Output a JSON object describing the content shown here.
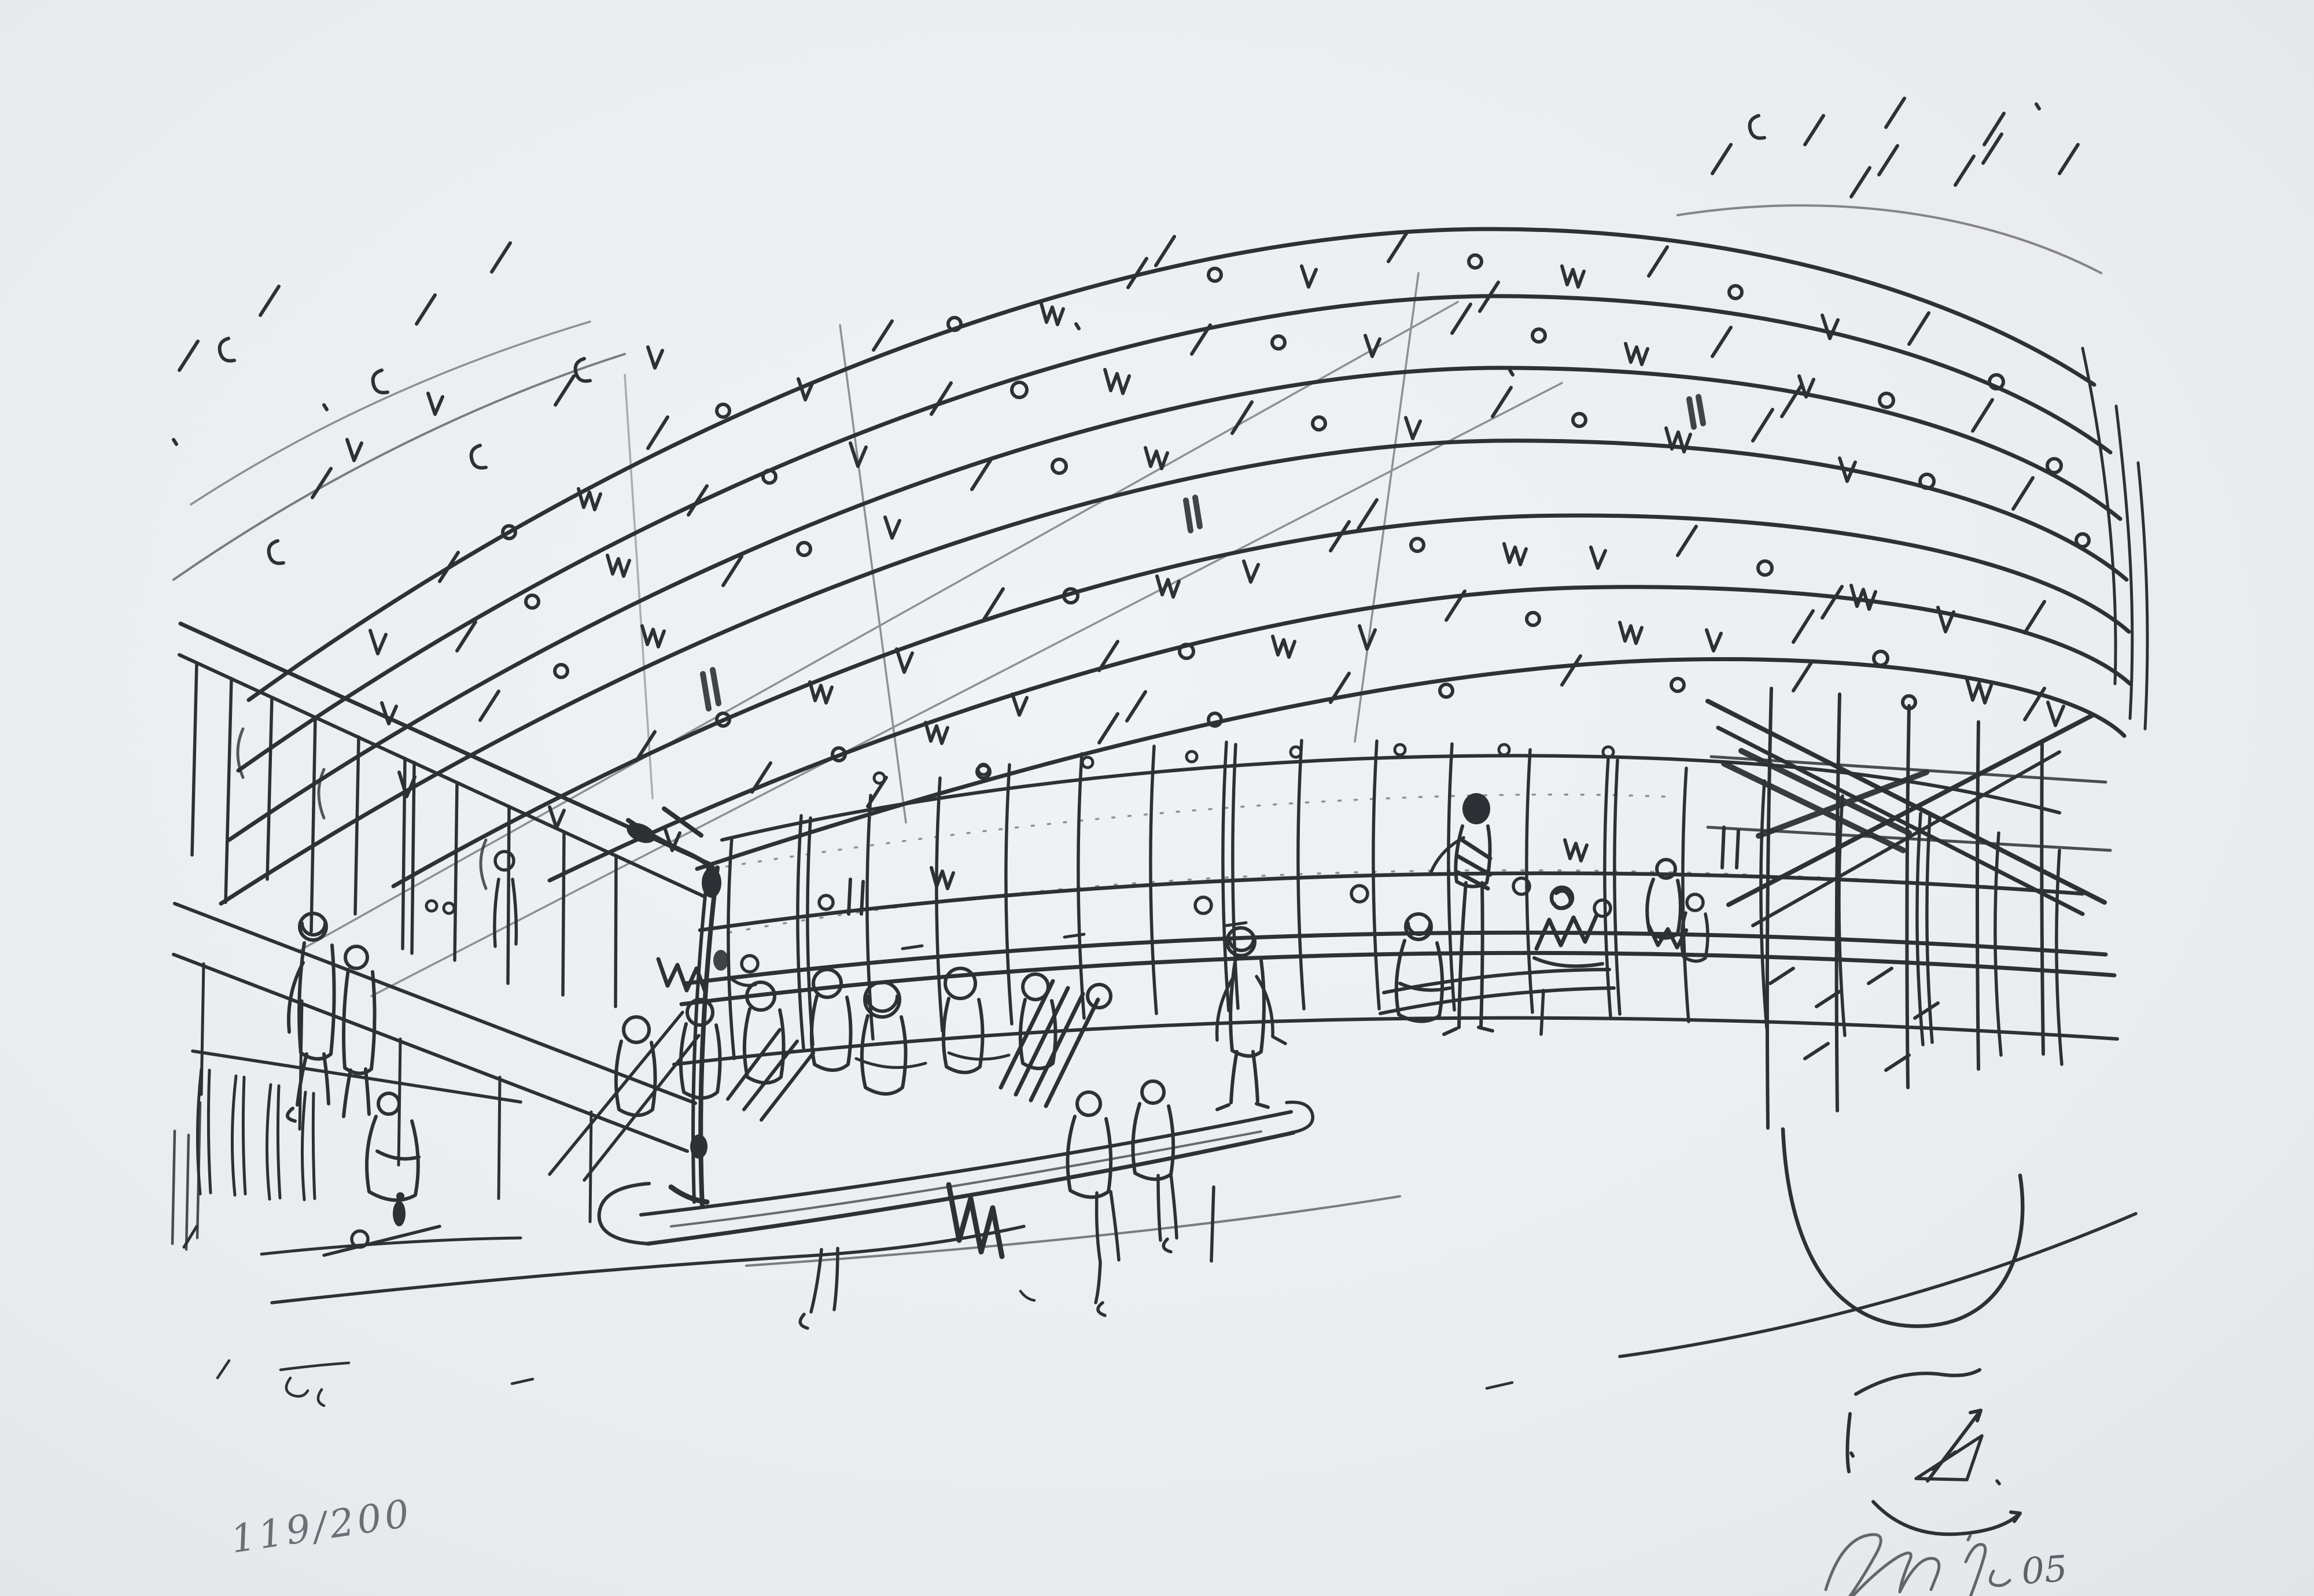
{
  "artwork": {
    "scene_alt": "Gestural black ink sketch of a large vaulted hall interior: concentric curved roof bands with scribbled structural marks, a glazed wall with mullions, small figures standing and seated at long counters, on off-white paper",
    "edition_number": "119/200",
    "signature": {
      "scrawl_alt": "Illegible pencil artist signature",
      "year_digits": "05"
    },
    "monogram_alt": "Small ink monogram doodle of an arched roof with arrow",
    "colors": {
      "paper": "#edeff2",
      "ink": "#2d3034",
      "pencil": "#595e66"
    }
  }
}
